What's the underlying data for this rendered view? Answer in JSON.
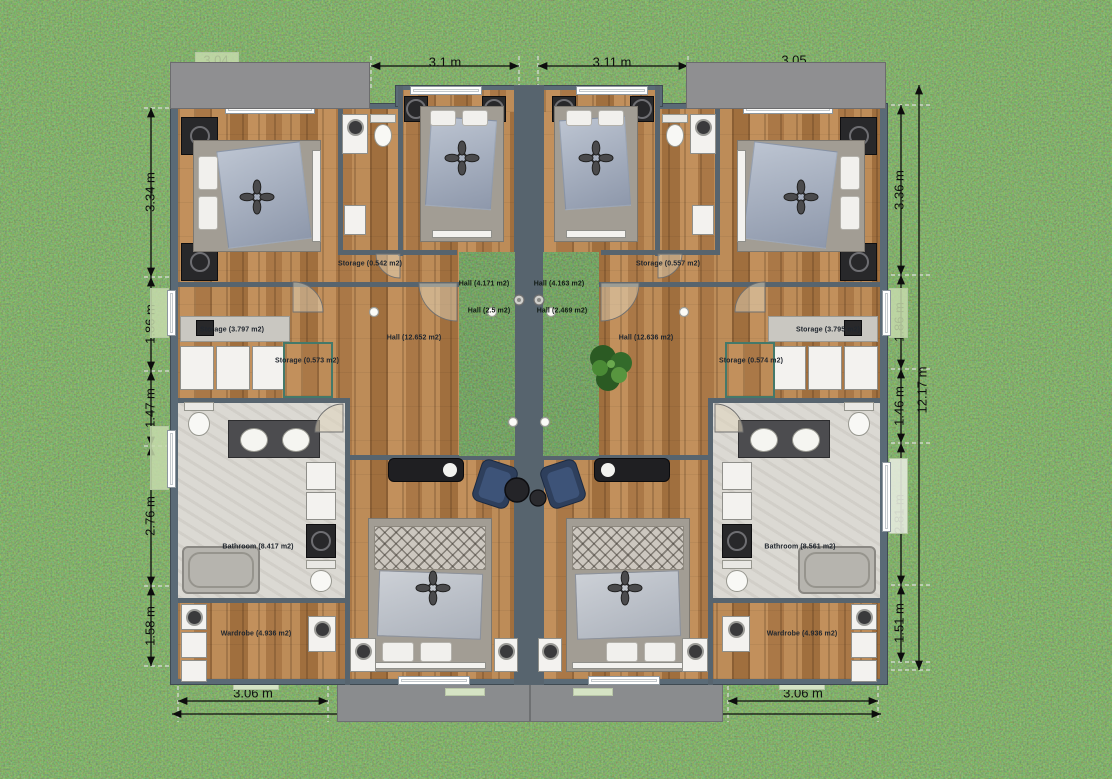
{
  "scene": {
    "type": "floor-plan-render",
    "description": "Top-down 2D rendered floor plan of a mirrored duplex on grass with dimension annotations",
    "colors": {
      "grass": "#4c7a38",
      "wood_floor": "#b5854f",
      "wall": "#5a6a76",
      "roof": "#8f8f91",
      "patio": "#8a8c8e",
      "tile": "#dbd9d3",
      "courtyard_green": "#3f6d33",
      "sage_accent": "#c6dbac",
      "chair_navy": "#2e3f5c",
      "dimension_text": "#0e0e0e"
    }
  },
  "dims": {
    "top": [
      "3.04",
      "3.1 m",
      "3.11 m",
      "3.05"
    ],
    "left": [
      "3.34 m",
      "1.86 m",
      "1.47 m",
      "2.76 m",
      "1.58 m"
    ],
    "right": [
      "3.36 m",
      "1.86 m",
      "1.46 m",
      "2.81 m",
      "1.51 m"
    ],
    "right_overall": "12.17 m",
    "bottom": [
      "3.06 m",
      "3.06 m"
    ]
  },
  "labels": {
    "left": {
      "storage_small": "Storage (0.542 m2)",
      "storage": "Storage (3.797 m2)",
      "closet": "Storage (0.573 m2)",
      "hall": "Hall (12.652 m2)",
      "bathroom": "Bathroom (8.417 m2)",
      "wardrobe": "Wardrobe (4.936 m2)"
    },
    "right": {
      "storage_small": "Storage (0.557 m2)",
      "storage": "Storage (3.795 m2)",
      "closet": "Storage (0.574 m2)",
      "hall": "Hall (12.636 m2)",
      "bathroom": "Bathroom (8.561 m2)",
      "wardrobe": "Wardrobe (4.936 m2)"
    },
    "courtyard_left": {
      "top": "Hall (4.171 m2)",
      "bottom": "Hall (2.5 m2)"
    },
    "courtyard_right": {
      "top": "Hall (4.163 m2)",
      "bottom": "Hall (2.469 m2)"
    }
  }
}
